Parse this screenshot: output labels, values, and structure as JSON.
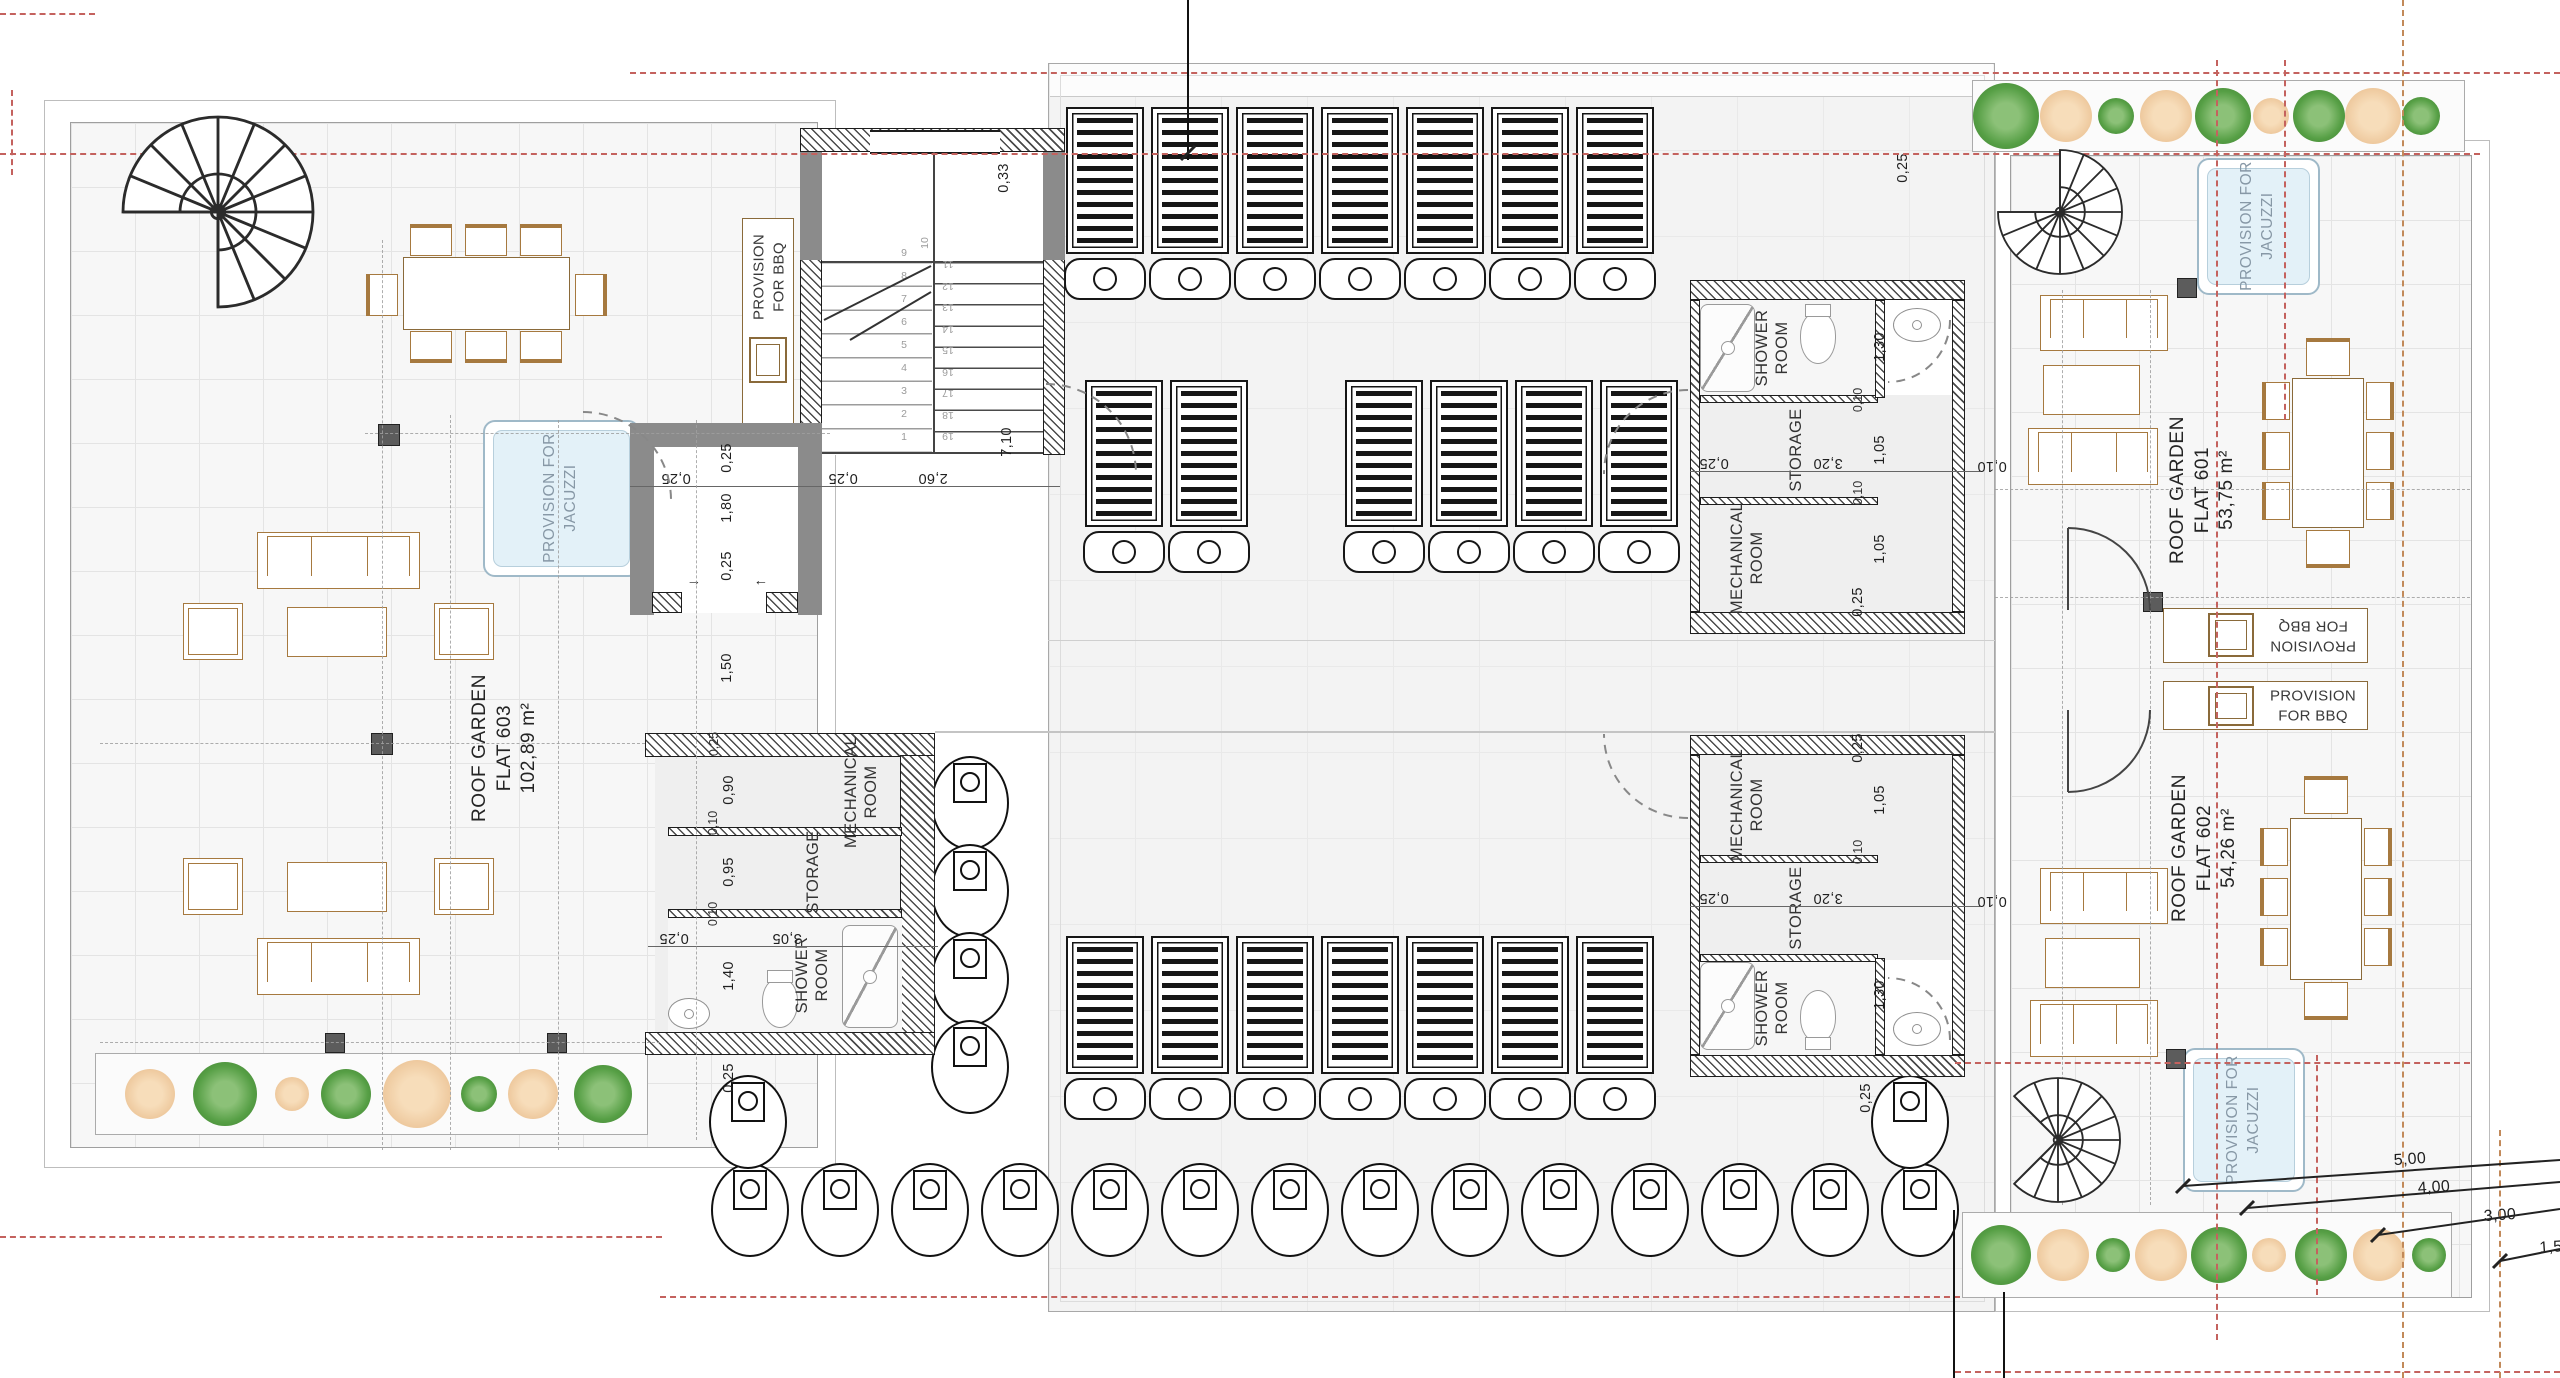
{
  "flats": {
    "f603": {
      "l1": "ROOF GARDEN",
      "l2": "FLAT 603",
      "l3": "102,89 m²"
    },
    "f601": {
      "l1": "ROOF GARDEN",
      "l2": "FLAT 601",
      "l3": "53,75 m²"
    },
    "f602": {
      "l1": "ROOF GARDEN",
      "l2": "FLAT 602",
      "l3": "54,26 m²"
    }
  },
  "provisions": {
    "bbq_l1": "PROVISION",
    "bbq_l2": "FOR BBQ",
    "jacuzzi_l1": "PROVISION FOR",
    "jacuzzi_l2": "JACUZZI"
  },
  "rooms": {
    "shower_l1": "SHOWER",
    "shower_l2": "ROOM",
    "storage": "STORAGE",
    "mech_l1": "MECHANICAL",
    "mech_l2": "ROOM"
  },
  "dims": {
    "d033": "0,33",
    "d710": "7,10",
    "d025": "0,25",
    "d180": "1,80",
    "d260": "2,60",
    "d150": "1,50",
    "d090": "0,90",
    "d010": "0,10",
    "d095": "0,95",
    "d140": "1,40",
    "d305": "3,05",
    "d130": "1,30",
    "d105": "1,05",
    "d320": "3,20",
    "d500": "5,00",
    "d400": "4,00",
    "d300": "3,00",
    "d15": "1,5"
  },
  "stairs": {
    "left_numbers": [
      "9",
      "8",
      "7",
      "6",
      "5",
      "4",
      "3",
      "2",
      "1"
    ],
    "right_numbers": [
      "11",
      "12",
      "13",
      "14",
      "15",
      "16",
      "17",
      "18",
      "19"
    ],
    "mid_number": "10",
    "dir_arrow_right": "→",
    "dir_arrow_left": "←"
  },
  "solar": {
    "row1": 7,
    "row2_left": 2,
    "row2_right": 4,
    "bottom_row": 7
  },
  "vents": {
    "bottom_row": 14,
    "left_column": 4
  },
  "trees": {
    "left": [
      {
        "x": 54,
        "d": 50,
        "cls": "t-tan"
      },
      {
        "x": 129,
        "d": 64,
        "cls": "t-green"
      },
      {
        "x": 196,
        "d": 34,
        "cls": "t-tan"
      },
      {
        "x": 250,
        "d": 50,
        "cls": "t-green"
      },
      {
        "x": 321,
        "d": 68,
        "cls": "t-tan"
      },
      {
        "x": 383,
        "d": 36,
        "cls": "t-green"
      },
      {
        "x": 437,
        "d": 50,
        "cls": "t-tan"
      },
      {
        "x": 507,
        "d": 58,
        "cls": "t-green"
      }
    ],
    "top_right": [
      {
        "x": 33,
        "d": 66,
        "cls": "t-green"
      },
      {
        "x": 93,
        "d": 52,
        "cls": "t-tan"
      },
      {
        "x": 143,
        "d": 36,
        "cls": "t-green"
      },
      {
        "x": 193,
        "d": 52,
        "cls": "t-tan"
      },
      {
        "x": 250,
        "d": 56,
        "cls": "t-green"
      },
      {
        "x": 298,
        "d": 36,
        "cls": "t-tan"
      },
      {
        "x": 346,
        "d": 52,
        "cls": "t-green"
      },
      {
        "x": 400,
        "d": 56,
        "cls": "t-tan"
      },
      {
        "x": 448,
        "d": 38,
        "cls": "t-green"
      }
    ],
    "bottom_right": [
      {
        "x": 38,
        "d": 60,
        "cls": "t-green"
      },
      {
        "x": 100,
        "d": 52,
        "cls": "t-tan"
      },
      {
        "x": 150,
        "d": 34,
        "cls": "t-green"
      },
      {
        "x": 198,
        "d": 52,
        "cls": "t-tan"
      },
      {
        "x": 256,
        "d": 56,
        "cls": "t-green"
      },
      {
        "x": 306,
        "d": 34,
        "cls": "t-tan"
      },
      {
        "x": 358,
        "d": 52,
        "cls": "t-green"
      },
      {
        "x": 416,
        "d": 52,
        "cls": "t-tan"
      },
      {
        "x": 466,
        "d": 34,
        "cls": "t-green"
      }
    ]
  }
}
